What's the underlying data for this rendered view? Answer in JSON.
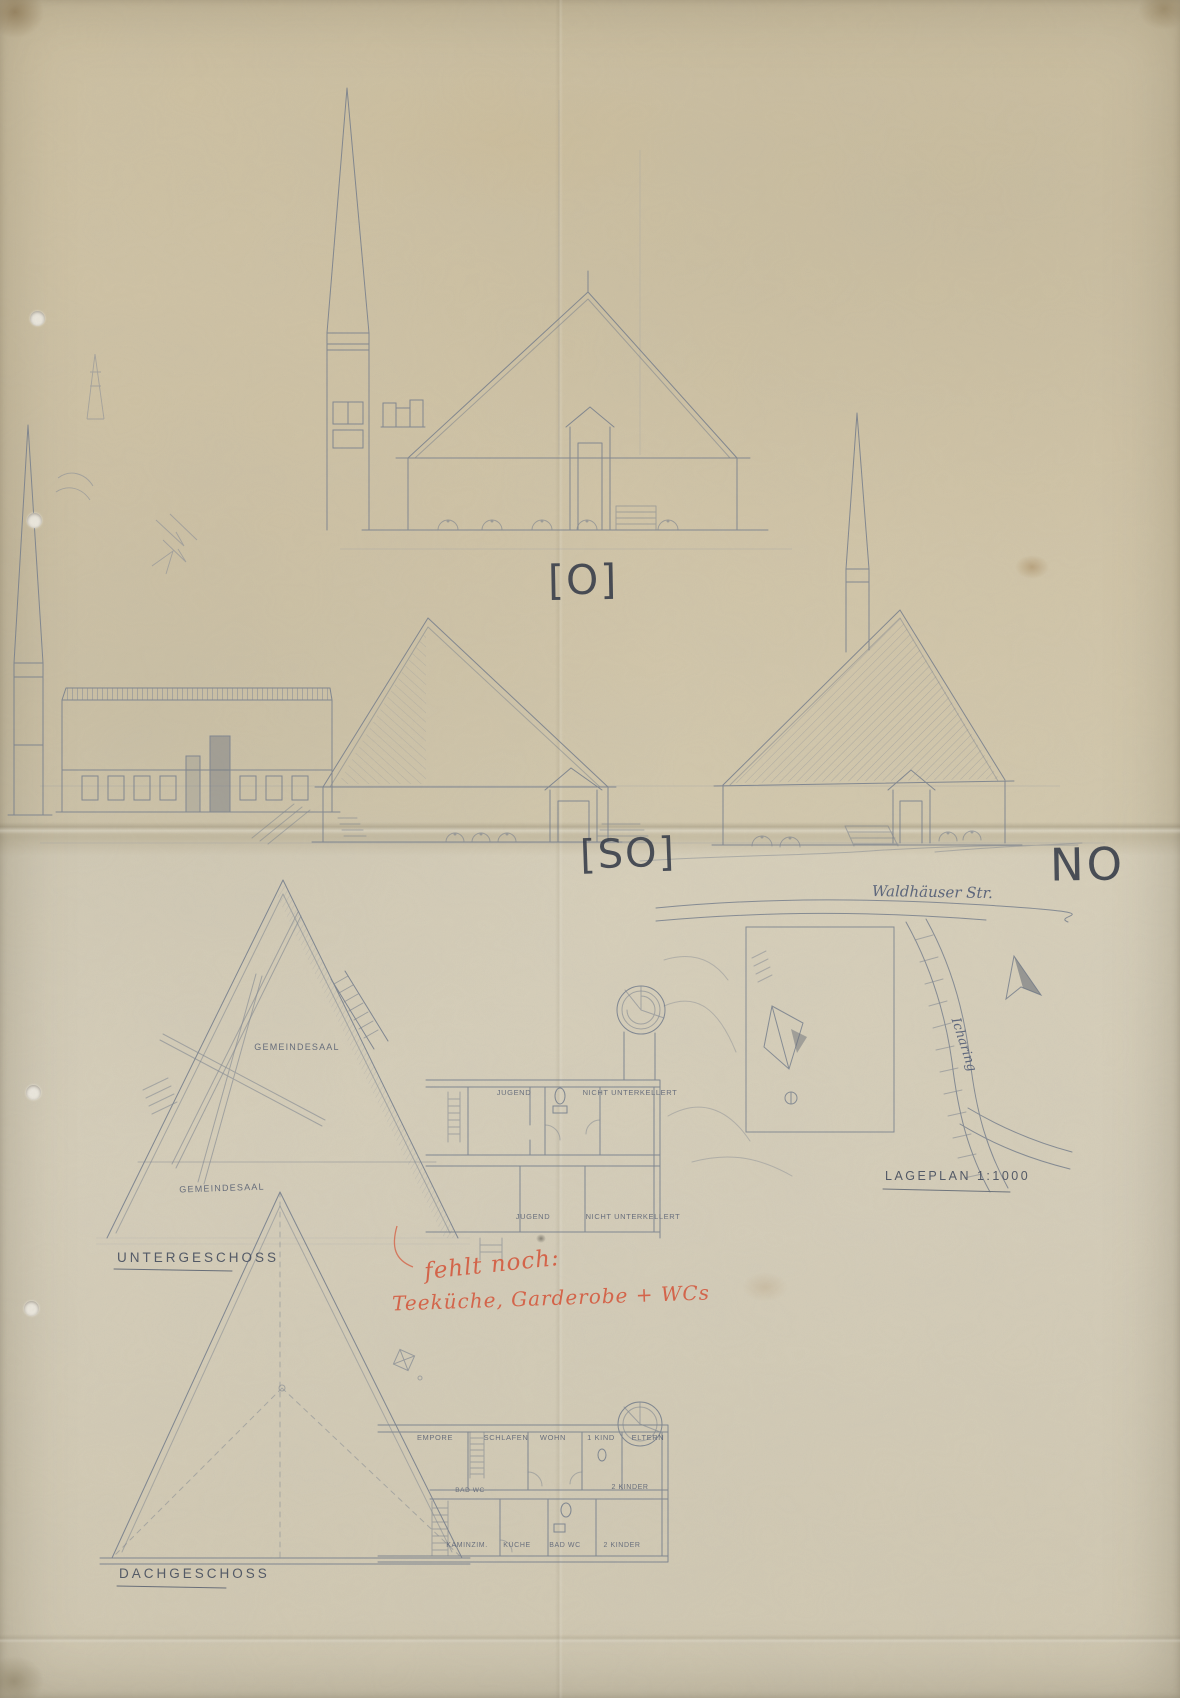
{
  "colors": {
    "paper": "#d4c9ae",
    "pencil": "#6e7889",
    "pencil_dark": "#3c4354",
    "red_ink": "#d8573a"
  },
  "elevations": {
    "east_label": "[O]",
    "southeast_label": "[SO]",
    "northeast_label": "NO"
  },
  "untergeschoss": {
    "title": "UNTERGESCHOSS",
    "room_gemeindesaal_upper": "GEMEINDESAAL",
    "room_gemeindesaal_lower": "GEMEINDESAAL",
    "room_jugend_upper": "JUGEND",
    "note_nicht_unterkellert_upper": "NICHT UNTERKELLERT",
    "room_jugend_lower": "JUGEND",
    "note_nicht_unterkellert_lower": "NICHT UNTERKELLERT"
  },
  "dachgeschoss": {
    "title": "DACHGESCHOSS",
    "room_empore": "EMPORE",
    "room_schlafen": "SCHLAFEN",
    "room_wohn": "WOHN",
    "room_kind": "1 KIND",
    "room_eltern": "ELTERN",
    "room_bad_mid": "BAD WC",
    "room_kinder_mid": "2 KINDER",
    "room_kaminzimmer": "KAMINZIM.",
    "room_kueche": "KÜCHE",
    "room_bad": "BAD WC",
    "room_kinder": "2 KINDER"
  },
  "site_plan": {
    "street_top": "Waldhäuser Str.",
    "street_right": "Icharing",
    "title": "LAGEPLAN 1:1000"
  },
  "red_note": {
    "line1": "fehlt noch:",
    "line2": "Teeküche, Garderobe + WCs"
  }
}
